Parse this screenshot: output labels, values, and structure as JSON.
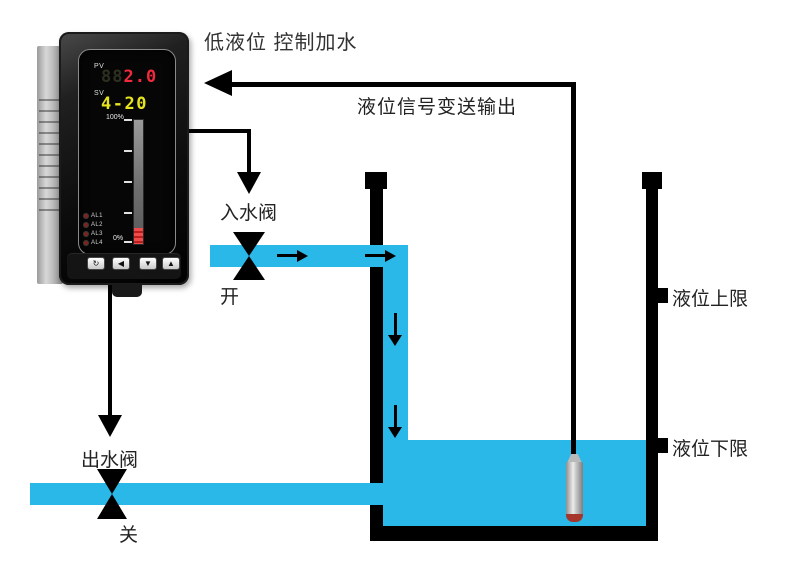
{
  "title": "低液位 控制加水",
  "colors": {
    "water": "#29b8e8",
    "pv_red": "#f02a3c",
    "sv_yellow": "#e6e41f",
    "bar_red": "#d93030",
    "line_black": "#000000"
  },
  "instrument": {
    "pv_label": "PV",
    "pv_ghost": "88",
    "pv_value": "2.0",
    "sv_label": "SV",
    "sv_value": "4-20",
    "bar_max_label": "100%",
    "bar_min_label": "0%",
    "alarm_labels": [
      "AL1",
      "AL2",
      "AL3",
      "AL4"
    ],
    "button_labels": [
      "↻",
      "◀",
      "▼",
      "▲"
    ]
  },
  "labels": {
    "signal_output": "液位信号变送输出",
    "inlet_valve": "入水阀",
    "inlet_state": "开",
    "outlet_valve": "出水阀",
    "outlet_state": "关",
    "upper_limit": "液位上限",
    "lower_limit": "液位下限"
  }
}
